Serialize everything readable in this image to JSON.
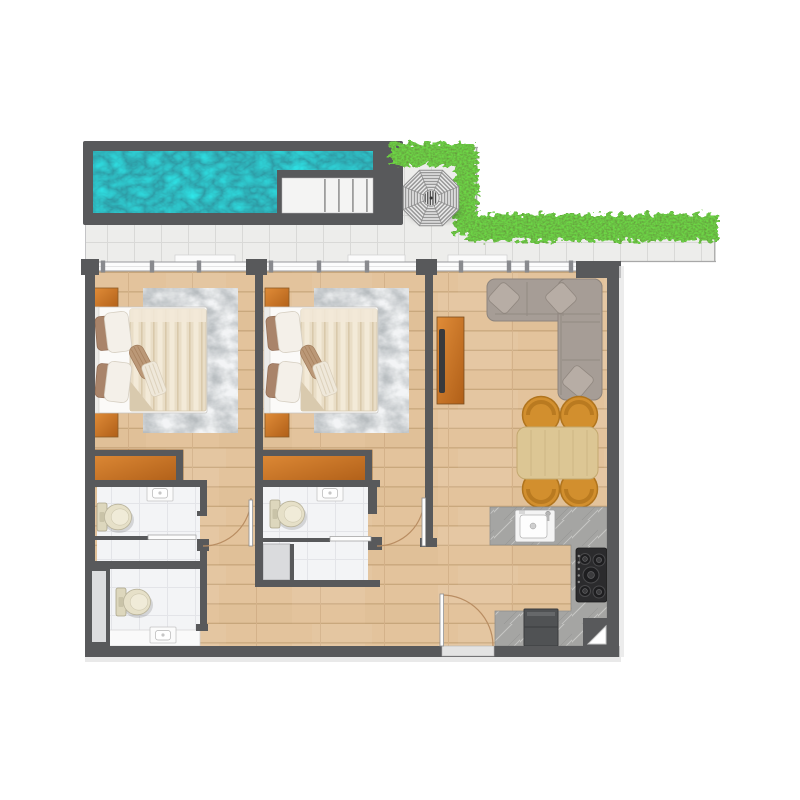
{
  "scene": {
    "kind": "apartment-floor-plan-top-view",
    "canvas_w": 800,
    "canvas_h": 800
  },
  "palette": {
    "background": "#ffffff",
    "wall": "#58595b",
    "pool_water": "#11707f",
    "terrace_tile": "#ededeb",
    "tile_line": "#d9d9d7",
    "hedge_green": "#467f1f",
    "umbrella_light": "#ececec",
    "umbrella_ring": "#989898",
    "wood_floor": "#e3c39c",
    "wood_line": "#c9a87d",
    "cabinet_wood_light": "#e08c38",
    "cabinet_wood_dark": "#b05f18",
    "rug_gray": "#b7bcbf",
    "bed_linen": "#fbfaf8",
    "blanket_beige": "#e9ddc6",
    "pillow_brown": "#a9846a",
    "pillow_white": "#f4f0e9",
    "sofa_gray": "#a69d96",
    "sofa_pillow": "#b7ada5",
    "dining_chair_orange": "#d28f2e",
    "dining_table_wood": "#dcc694",
    "counter_marble": "#a5a5a3",
    "stove_black": "#2b2b2d",
    "appliance_dark": "#505254",
    "bathroom_tile": "#f3f4f6",
    "fixture_cream": "#e6e0c8",
    "shower_gray": "#dadbdd",
    "door_arc": "#b98d62",
    "door_leaf": "#fdfdfd",
    "stair_tread": "#9e9e9e"
  },
  "inventory": {
    "outdoor": [
      "swimming-pool",
      "pool-stairs",
      "terrace-tiles",
      "garden-hedge",
      "parasol-umbrella"
    ],
    "bedroom_1": [
      "double-bed",
      "nightstand-top",
      "nightstand-bottom",
      "area-rug",
      "wardrobe",
      "ensuite-bathroom"
    ],
    "bedroom_2": [
      "double-bed",
      "nightstand-top",
      "nightstand-bottom",
      "area-rug",
      "wardrobe",
      "ensuite-bathroom"
    ],
    "living_dining": [
      "corner-sofa",
      "sofa-pillows",
      "tv-console",
      "dining-table",
      "dining-chairs"
    ],
    "kitchen": [
      "counter",
      "sink",
      "cooktop",
      "tall-appliance"
    ],
    "bathrooms": [
      "toilet",
      "washbasin",
      "shower",
      "service-shaft",
      "vanity"
    ],
    "doors": [
      "bedroom-1-door",
      "bedroom-2-door",
      "entry-door",
      "bathroom-door-leaves"
    ]
  },
  "counts": {
    "bedrooms": 2,
    "bathrooms": 3,
    "toilets": 3,
    "washbasins": 3,
    "dining_chairs": 4,
    "stair_treads": 4,
    "cooktop_burners": 5,
    "sofa_throw_pillows": 3,
    "door_swing_arcs": 3
  }
}
